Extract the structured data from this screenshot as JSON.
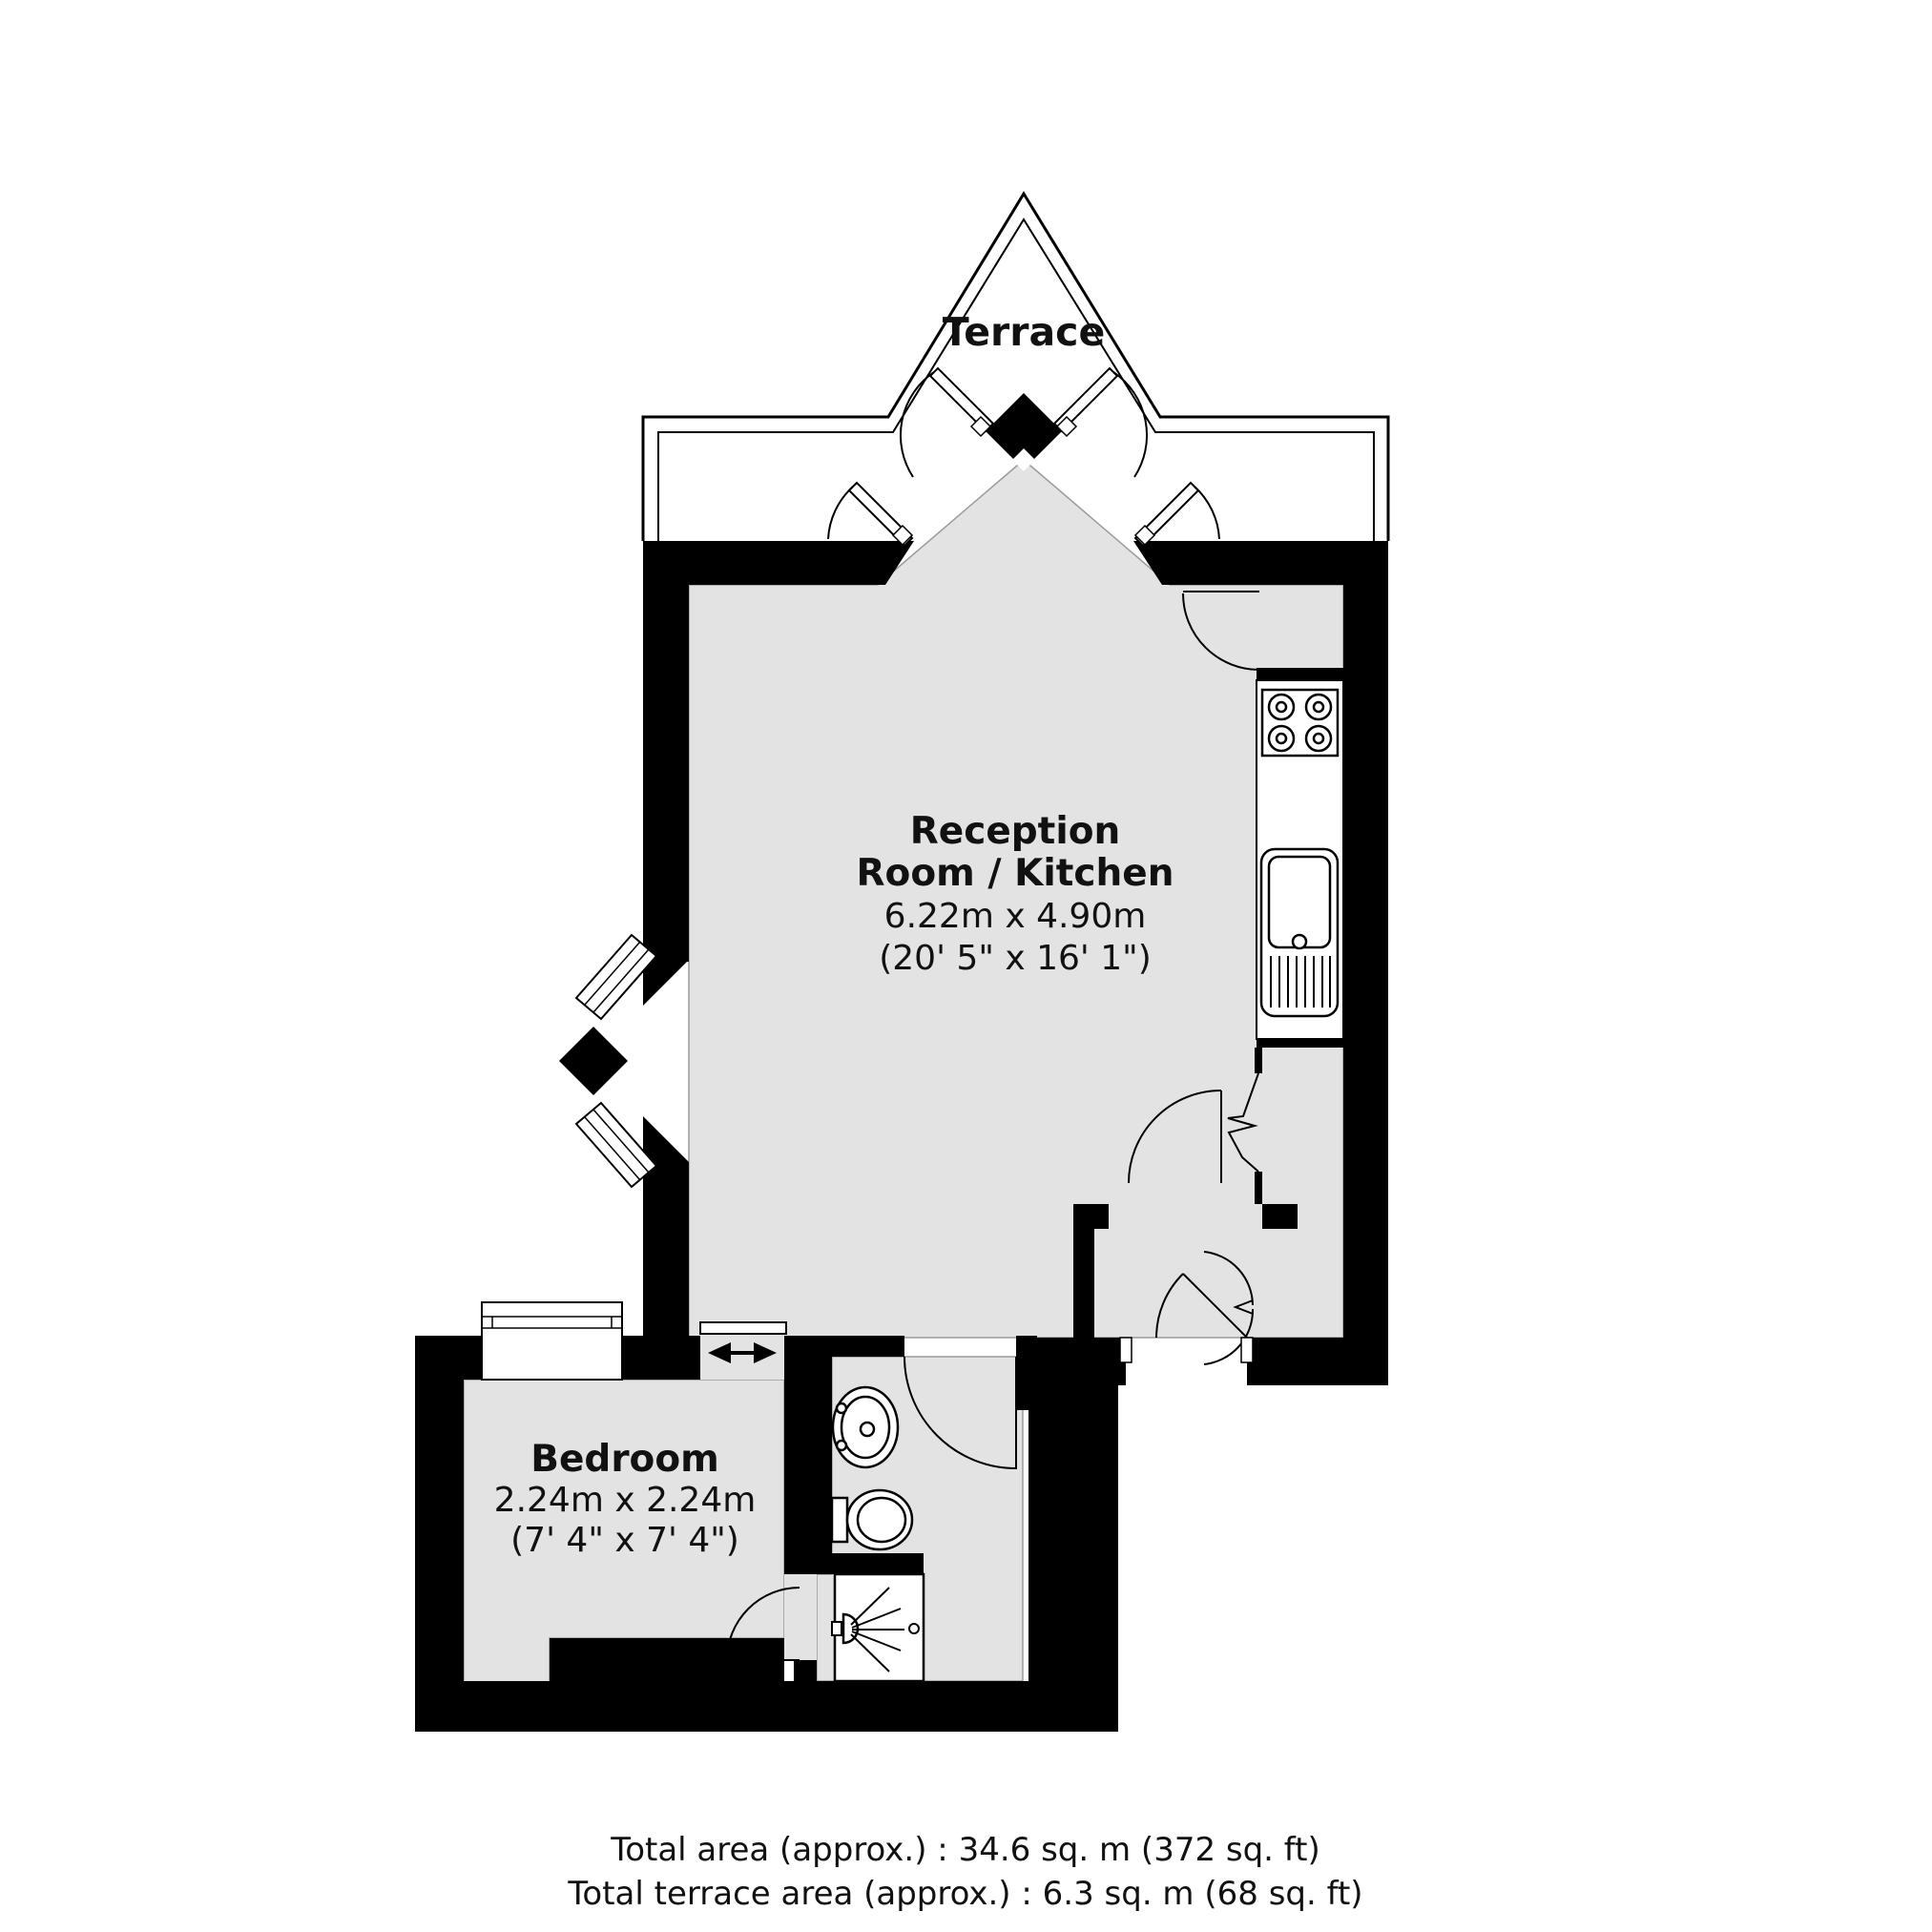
{
  "title": "Flat floor plan",
  "colors": {
    "wall": "#000000",
    "floor": "#e3e3e3",
    "background": "#ffffff",
    "line": "#1a1a1a"
  },
  "terrace": {
    "label": "Terrace"
  },
  "rooms": {
    "reception": {
      "name_line1": "Reception",
      "name_line2": "Room / Kitchen",
      "dimensions_metric": "6.22m x 4.90m",
      "dimensions_imperial": "(20' 5\" x 16' 1\")"
    },
    "bedroom": {
      "name": "Bedroom",
      "dimensions_metric": "2.24m x 2.24m",
      "dimensions_imperial": "(7' 4\" x 7' 4\")"
    }
  },
  "fixtures": {
    "hob": "4-ring hob",
    "kitchen_sink": "kitchen sink with drainer",
    "basin": "wash basin",
    "toilet": "toilet",
    "shower": "shower",
    "bay_window": "angled bay window",
    "bedroom_window": "bedroom window",
    "sliding_door": "sliding door",
    "french_doors": "french doors to terrace",
    "entrance_door": "entrance door"
  },
  "footer": {
    "line1": "Total area (approx.) : 34.6 sq. m (372 sq. ft)",
    "line2": "Total terrace area (approx.) : 6.3 sq. m (68 sq. ft)"
  }
}
